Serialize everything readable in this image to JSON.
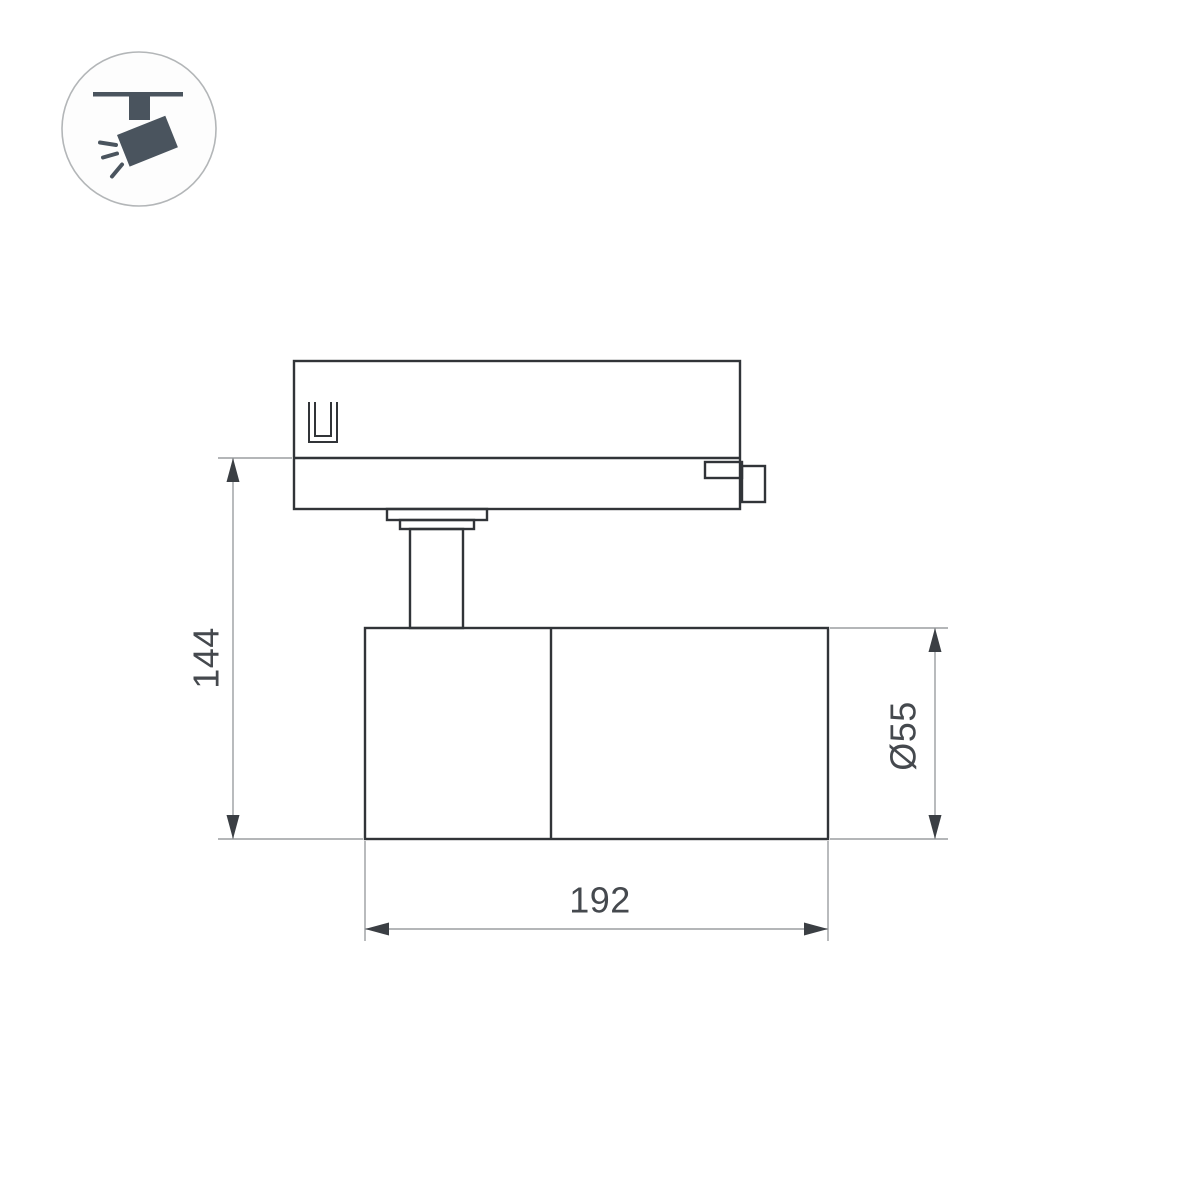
{
  "badge": {
    "icon_name": "track-spotlight-icon",
    "circle_border_color": "#b3b6b8",
    "glyph_color": "#4a545e"
  },
  "dimensions": {
    "height_label": "144",
    "diameter_label": "Ø55",
    "length_label": "192"
  },
  "style": {
    "background_color": "#ffffff",
    "outline_color": "#313438",
    "dimension_line_color": "#9b9ea1",
    "arrow_color": "#3b3f44",
    "text_color": "#45494e"
  }
}
